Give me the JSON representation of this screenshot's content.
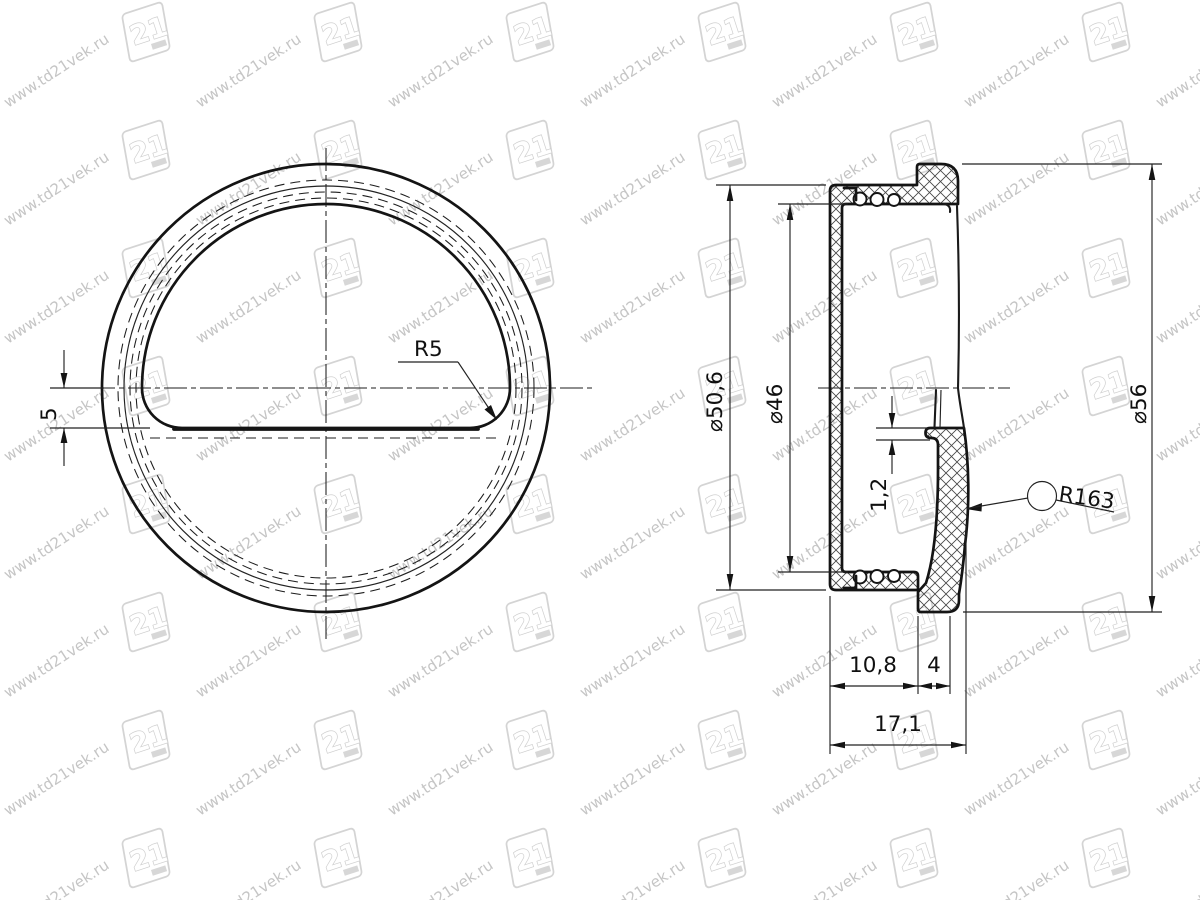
{
  "watermark": {
    "url": "www.td21vek.ru",
    "logo": "21",
    "color": "#c5c5c5"
  },
  "front": {
    "offset_5": "5",
    "r5": "R5"
  },
  "section": {
    "d50_6": "⌀50,6",
    "d46": "⌀46",
    "d56": "⌀56",
    "t1_2": "1,2",
    "r163": "R163",
    "w10_8": "10,8",
    "w4": "4",
    "w17_1": "17,1"
  }
}
